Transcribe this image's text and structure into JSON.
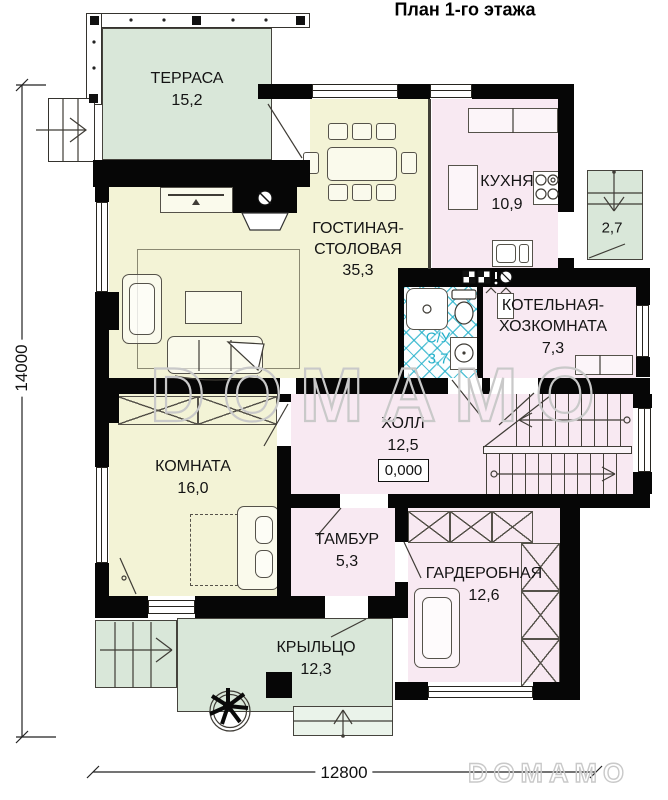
{
  "title": "План 1-го этажа",
  "watermark": {
    "center": "DOMAMO",
    "corner": "DOMAMO"
  },
  "dimensions": {
    "overall_height_mm": "14000",
    "overall_width_mm": "12800"
  },
  "rooms": {
    "terrace": {
      "label": "ТЕРРАСА",
      "area": "15,2"
    },
    "living": {
      "label1": "ГОСТИНАЯ-",
      "label2": "СТОЛОВАЯ",
      "area": "35,3"
    },
    "kitchen": {
      "label": "КУХНЯ",
      "area": "10,9"
    },
    "entry_porch": {
      "area": "2,7"
    },
    "bathroom": {
      "label": "С/У",
      "area": "3,7"
    },
    "boiler": {
      "label1": "КОТЕЛЬНАЯ-",
      "label2": "ХОЗКОМНАТА",
      "area": "7,3"
    },
    "hall": {
      "label": "ХОЛЛ",
      "area": "12,5",
      "elevation_mark": "0,000"
    },
    "room": {
      "label": "КОМНАТА",
      "area": "16,0"
    },
    "tambour": {
      "label": "ТАМБУР",
      "area": "5,3"
    },
    "wardrobe": {
      "label": "ГАРДЕРОБНАЯ",
      "area": "12,6"
    },
    "porch": {
      "label": "КРЫЛЬЦО",
      "area": "12,3"
    }
  },
  "colors": {
    "green": "#d9e7d9",
    "yellow": "#f3f3d6",
    "pink": "#f8e9f2",
    "cyan": "#1fafc9",
    "wall": "#060606",
    "line": "#55524a",
    "watermark": "#c9c9c9"
  }
}
